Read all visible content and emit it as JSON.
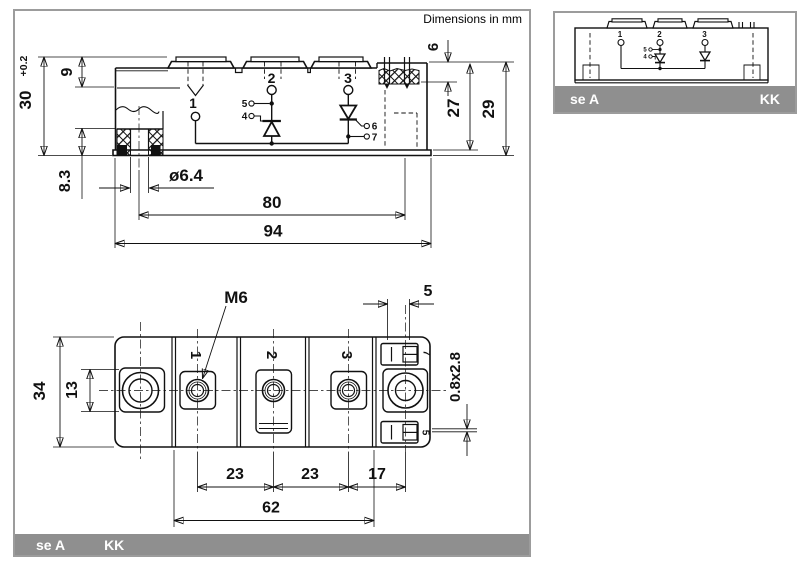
{
  "note": "Dimensions in mm",
  "colors": {
    "line": "#111111",
    "bar_gray": "#8f8f8f",
    "panel_border": "#9c9c9c",
    "bar_text": "#ffffff"
  },
  "side_view": {
    "dim_total_height": "30",
    "dim_total_height_tol": "+0.2",
    "dim_step_height": "9",
    "dim_foot_height": "8.3",
    "dim_hole_dia": "ø6.4",
    "dim_hole_pitch": "80",
    "dim_total_length": "94",
    "dim_right_step": "6",
    "dim_body_height": "27",
    "dim_overall_height_right": "29",
    "terminal_1": "1",
    "terminal_2": "2",
    "terminal_3": "3",
    "gate_5": "5",
    "gate_4": "4",
    "gate_6": "6",
    "gate_7": "7"
  },
  "bottom_view": {
    "dim_thread": "M6",
    "dim_tab_length": "5",
    "dim_tab_cross_section": "0.8x2.8",
    "dim_width": "34",
    "dim_slot": "13",
    "dim_pitch_12": "23",
    "dim_pitch_23": "23",
    "dim_pitch_3_hole": "17",
    "dim_terminal_span": "62",
    "terminal_1": "1",
    "terminal_2": "2",
    "terminal_3": "3",
    "tab_7": "7",
    "tab_5": "5"
  },
  "footer": {
    "left_label": "se A",
    "right_label": "KK"
  },
  "detail_view": {
    "terminal_1": "1",
    "terminal_2": "2",
    "terminal_3": "3",
    "gate_5": "5",
    "gate_4": "4",
    "footer_left": "se A",
    "footer_right": "KK"
  }
}
